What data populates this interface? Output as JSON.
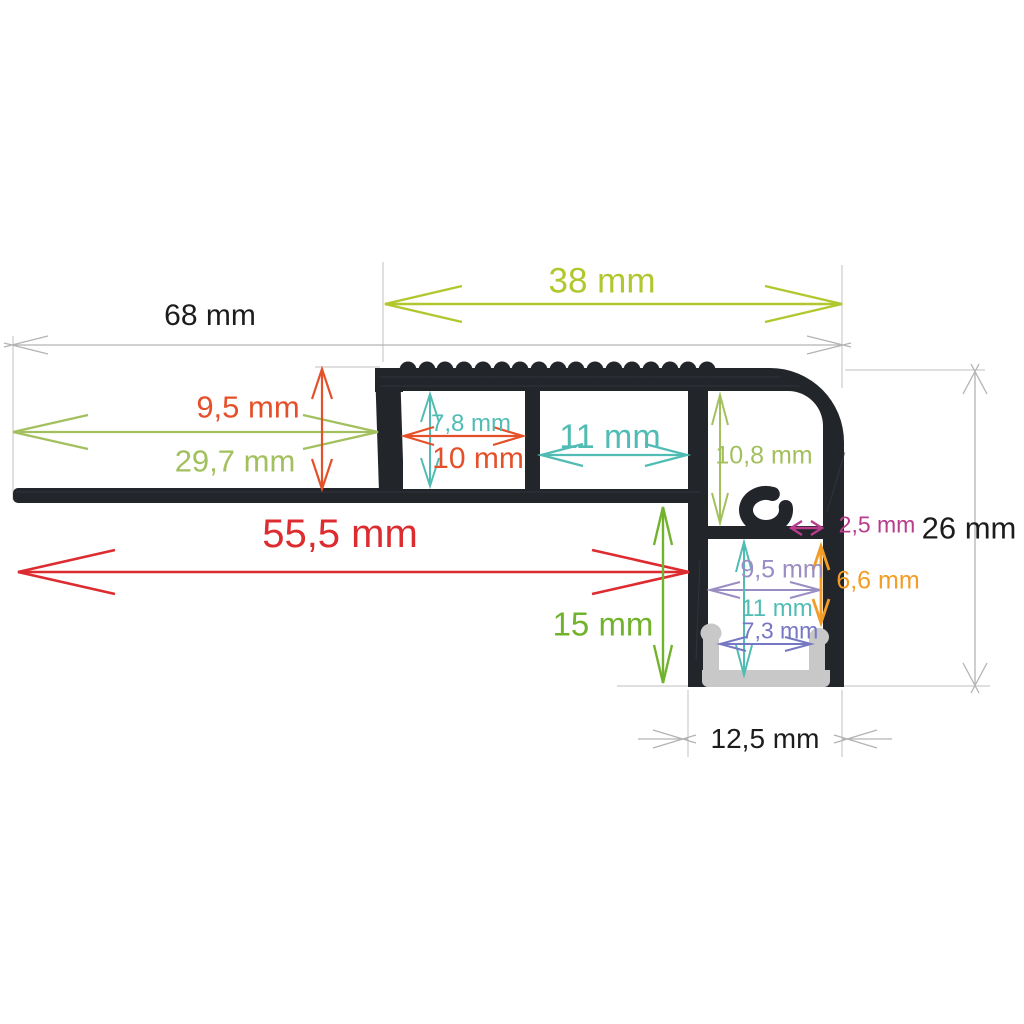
{
  "canvas": {
    "width": 1024,
    "height": 1024,
    "background": "#ffffff"
  },
  "diagram": {
    "type": "technical-drawing",
    "subject": "aluminium LED stair-nosing profile cross-section with dimension annotations",
    "unit": "mm",
    "profile_color": "#22252a",
    "led_channel_color": "#c8c8c8",
    "extension_line_color": "#cccccc",
    "labels": {
      "d38": {
        "text": "38 mm",
        "value": 38,
        "color": "#b2c72e",
        "orientation": "horizontal"
      },
      "d68": {
        "text": "68 mm",
        "value": 68,
        "color": "#1c1c1c",
        "orientation": "horizontal"
      },
      "d95t": {
        "text": "9,5 mm",
        "value": 9.5,
        "color": "#e4502a",
        "orientation": "vertical"
      },
      "d297": {
        "text": "29,7 mm",
        "value": 29.7,
        "color": "#a3c05e",
        "orientation": "horizontal"
      },
      "d78": {
        "text": "7,8 mm",
        "value": 7.8,
        "color": "#50bcb4",
        "orientation": "vertical"
      },
      "d10": {
        "text": "10 mm",
        "value": 10,
        "color": "#e4502a",
        "orientation": "horizontal"
      },
      "d11t": {
        "text": "11 mm",
        "value": 11,
        "color": "#50bcb4",
        "orientation": "horizontal"
      },
      "d108": {
        "text": "10,8 mm",
        "value": 10.8,
        "color": "#a3c05e",
        "orientation": "vertical"
      },
      "d25": {
        "text": "2,5 mm",
        "value": 2.5,
        "color": "#b83b8c",
        "orientation": "horizontal"
      },
      "d26": {
        "text": "26 mm",
        "value": 26,
        "color": "#1c1c1c",
        "orientation": "vertical"
      },
      "d555": {
        "text": "55,5 mm",
        "value": 55.5,
        "color": "#dc2c30",
        "orientation": "horizontal"
      },
      "d95b": {
        "text": "9,5 mm",
        "value": 9.5,
        "color": "#9a8dc3",
        "orientation": "horizontal"
      },
      "d66": {
        "text": "6,6 mm",
        "value": 6.6,
        "color": "#f49d26",
        "orientation": "vertical"
      },
      "d11b": {
        "text": "11 mm",
        "value": 11,
        "color": "#50bcb4",
        "orientation": "vertical"
      },
      "d73": {
        "text": "7,3 mm",
        "value": 7.3,
        "color": "#7677c3",
        "orientation": "horizontal"
      },
      "d15": {
        "text": "15 mm",
        "value": 15,
        "color": "#72b32e",
        "orientation": "vertical"
      },
      "d125": {
        "text": "12,5 mm",
        "value": 12.5,
        "color": "#1c1c1c",
        "orientation": "horizontal"
      }
    }
  }
}
